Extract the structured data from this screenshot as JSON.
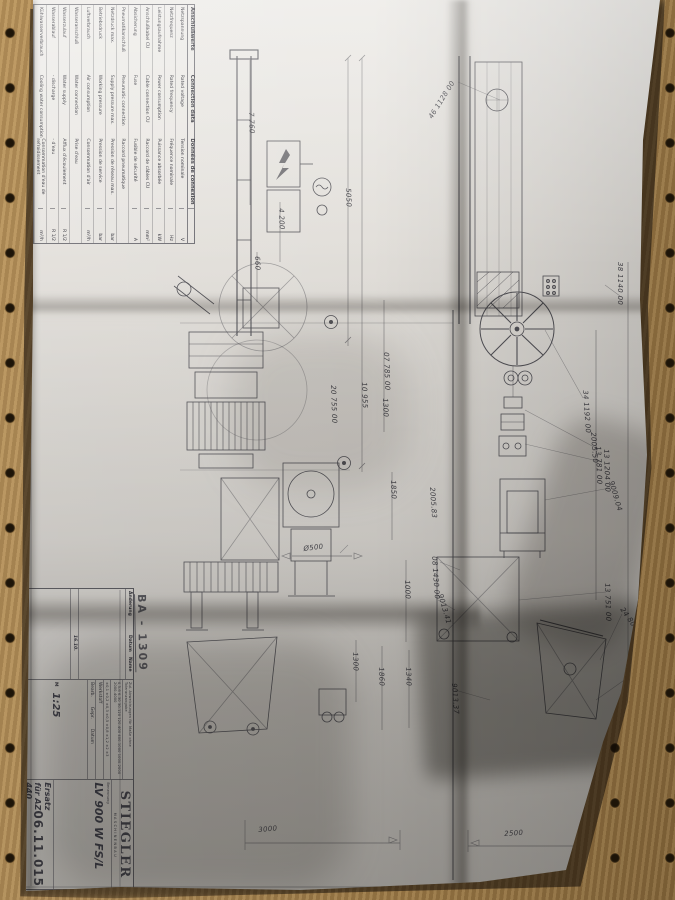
{
  "colors": {
    "pegboard": "#a98754",
    "paper": "#dcd9d4",
    "ink": "#2b2b33"
  },
  "stamp": "BA - 1309",
  "labels": {
    "part_numbers": [
      "46 1128 00",
      "38 1140 00",
      "34 1192 00",
      "2005.50",
      "13 781 00",
      "13 1204 00",
      "9009.04",
      "13 751 00",
      "24 806 00",
      "12 1840 00",
      "9009.42",
      "07 785 00",
      "20 755 00",
      "2005.83",
      "08 1430 00",
      "9013.41",
      "9013.37"
    ],
    "dimensions": [
      "5050",
      "7 760",
      "4 200",
      "660",
      "10 955",
      "1300",
      "1850",
      "1000",
      "1300",
      "1860",
      "1340",
      "Ø500",
      "3000",
      "2500"
    ]
  },
  "connection_table": {
    "headers": {
      "de": "Anschlußwerte",
      "en": "Connection data",
      "fr": "Données de connexion"
    },
    "rows": [
      {
        "de": "Netzspannung",
        "en": "Rated voltage",
        "fr": "Tension nominale",
        "value": "V"
      },
      {
        "de": "Netzfrequenz",
        "en": "Rated frequency",
        "fr": "Fréquence nominale",
        "value": "Hz"
      },
      {
        "de": "Leistungsaufnahme",
        "en": "Power consumption",
        "fr": "Puissance absorbée",
        "value": "kW"
      },
      {
        "de": "Anschlußkabel CU",
        "en": "Cable connection CU",
        "fr": "Raccord de câbles CU",
        "value": "mm²"
      },
      {
        "de": "Absicherung",
        "en": "Fuse",
        "fr": "Fusible de sécurité",
        "value": "A"
      },
      {
        "de": "Pneumatikanschluß",
        "en": "Pneumatic connection",
        "fr": "Raccord pneumatique",
        "value": ""
      },
      {
        "de": "Netzdruck max.",
        "en": "Supply pressure max.",
        "fr": "Pression de réseau max.",
        "value": "bar"
      },
      {
        "de": "Betriebsdruck",
        "en": "Working pressure",
        "fr": "Pression de service",
        "value": "bar"
      },
      {
        "de": "Luftverbrauch",
        "en": "Air consumption",
        "fr": "Consommation d'air",
        "value": "m³/h"
      },
      {
        "de": "Wasseranschluß",
        "en": "Water connection",
        "fr": "Prise d'eau",
        "value": ""
      },
      {
        "de": "Wasserzulauf",
        "en": "Water supply",
        "fr": "Afflux d'écoulement",
        "value": "R 1/2"
      },
      {
        "de": "Wasserablauf",
        "en": "- discharge",
        "fr": "- d'eau",
        "value": "R 1/2"
      },
      {
        "de": "Kühlwasserverbrauch",
        "en": "Cooling water consumption",
        "fr": "Consommation d'eau de refroidissement",
        "value": "m³/h"
      }
    ]
  },
  "title_block": {
    "aenderung_label": "Änderung",
    "datum_label": "Datum",
    "name_label": "Name",
    "date_entry": "16.10.",
    "tol_note": "Zul. Abweichungen für Maße ohne Toleranzangabe",
    "tol_ranges": "0,5-6  6-30  30-120  120-400  400-1000  1000-2000  2000-4000",
    "tol_values": "±0,1  ±0,2  ±0,3  ±0,5  ±0,8  ±1,2  ±2  ±3",
    "werkstoff_label": "Werkstoff",
    "bearb_label": "Bearb.",
    "gepr_label": "Gepr.",
    "massstab_label": "M",
    "scale": "1:25",
    "benennung_label": "Benennung",
    "title": "LV 900 W FS/L",
    "replacement": "Ersatz für AZ 440",
    "company": "STIEGLER",
    "company_sub": "M A S C H I N E N B A U",
    "drawing_number": "06.11.015"
  }
}
